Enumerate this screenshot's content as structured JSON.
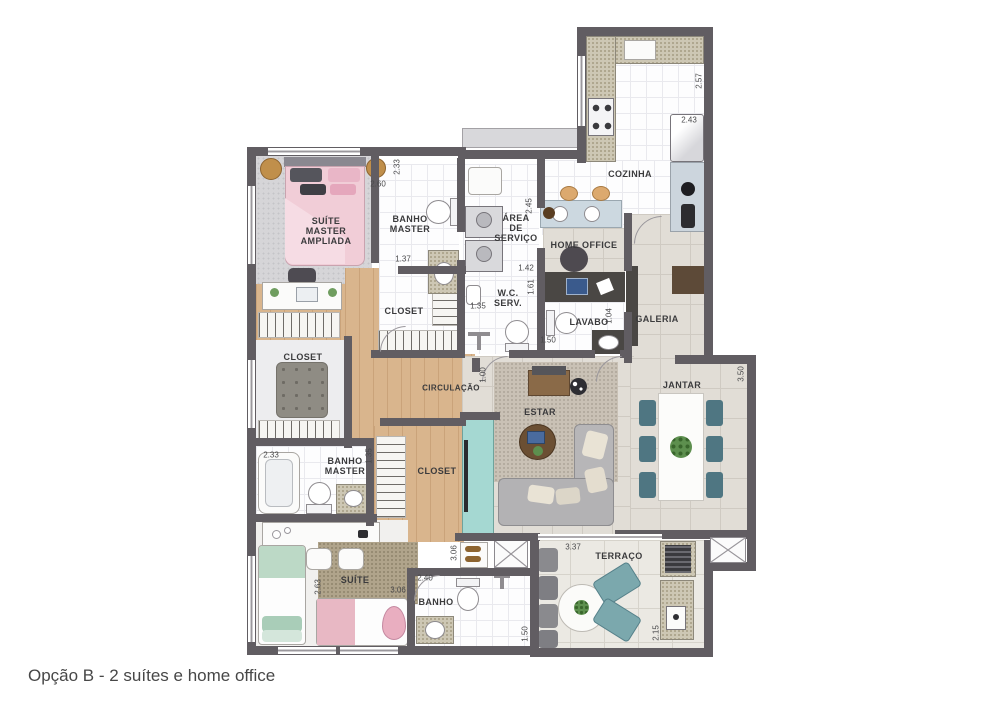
{
  "caption": "Opção B - 2 suítes e home office",
  "colors": {
    "wall": "#615d62",
    "wood_floor": "#d9b58d",
    "teal_accent": "#a5d8d2",
    "bed_pink": "#f1cdd7",
    "bed_mint": "#bcd9c6",
    "dining_chair_teal": "#4f7682"
  },
  "plan": {
    "rooms": [
      {
        "name": "suite-master-ampliada",
        "label": "SUÍTE\nMASTER\nAMPLIADA"
      },
      {
        "name": "banho-master-top",
        "label": "BANHO\nMASTER"
      },
      {
        "name": "area-de-servico",
        "label": "ÁREA\nDE\nSERVIÇO"
      },
      {
        "name": "cozinha",
        "label": "COZINHA"
      },
      {
        "name": "home-office",
        "label": "HOME OFFICE"
      },
      {
        "name": "wc-serv",
        "label": "W.C.\nSERV."
      },
      {
        "name": "lavabo",
        "label": "LAVABO"
      },
      {
        "name": "galeria",
        "label": "GALERIA"
      },
      {
        "name": "closet-central",
        "label": "CLOSET"
      },
      {
        "name": "closet-left",
        "label": "CLOSET"
      },
      {
        "name": "circulacao",
        "label": "CIRCULAÇÃO"
      },
      {
        "name": "estar",
        "label": "ESTAR"
      },
      {
        "name": "jantar",
        "label": "JANTAR"
      },
      {
        "name": "banho-master-bottom",
        "label": "BANHO\nMASTER"
      },
      {
        "name": "closet-bottom",
        "label": "CLOSET"
      },
      {
        "name": "suite",
        "label": "SUÍTE"
      },
      {
        "name": "banho-bottom",
        "label": "BANHO"
      },
      {
        "name": "terraco",
        "label": "TERRAÇO"
      }
    ],
    "dims": [
      {
        "v": "2.33"
      },
      {
        "v": "2.60"
      },
      {
        "v": "1.37"
      },
      {
        "v": "2.45"
      },
      {
        "v": "1.42"
      },
      {
        "v": "1.61"
      },
      {
        "v": "1.35"
      },
      {
        "v": "2.57"
      },
      {
        "v": "2.43"
      },
      {
        "v": "1.50"
      },
      {
        "v": "1.04"
      },
      {
        "v": "1.00"
      },
      {
        "v": "3.50"
      },
      {
        "v": "2.33"
      },
      {
        "v": "1.35"
      },
      {
        "v": "2.63"
      },
      {
        "v": "3.06"
      },
      {
        "v": "3.06"
      },
      {
        "v": "2.40"
      },
      {
        "v": "1.50"
      },
      {
        "v": "3.37"
      },
      {
        "v": "2.15"
      }
    ]
  }
}
